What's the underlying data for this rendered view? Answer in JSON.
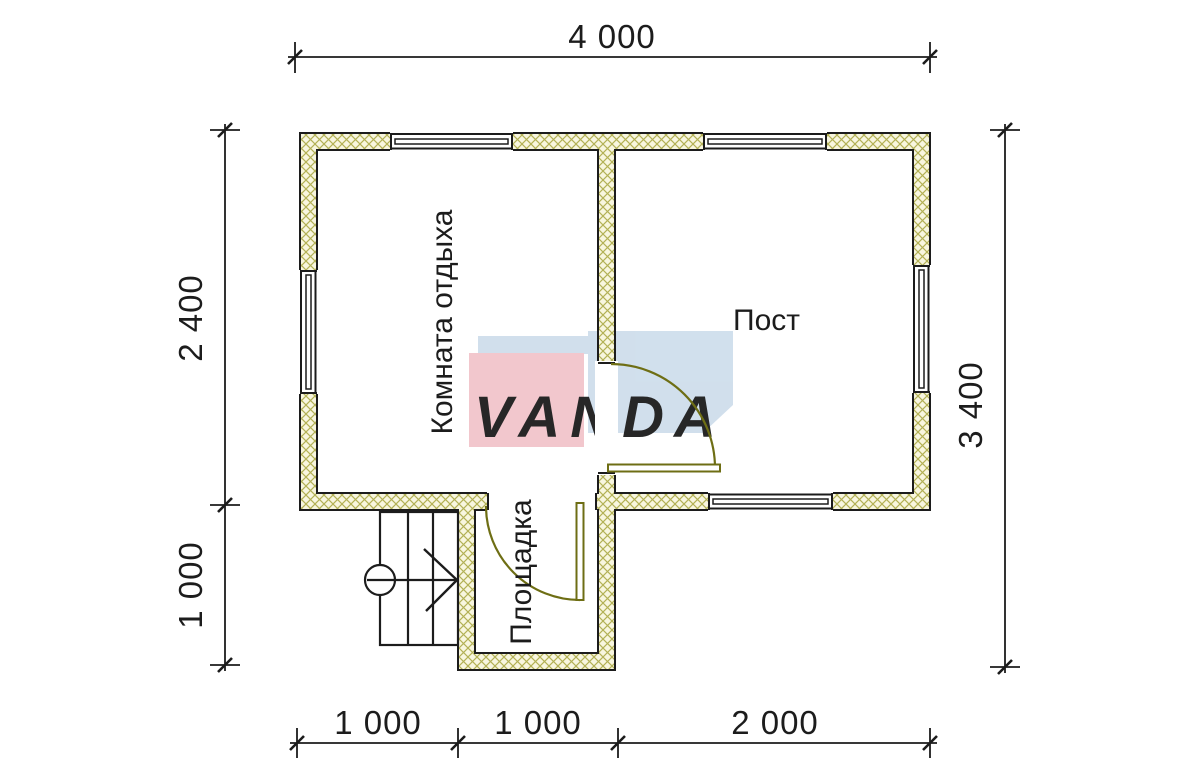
{
  "plan": {
    "rooms": {
      "rest": {
        "label": "Комната отдыха"
      },
      "post": {
        "label": "Пост"
      },
      "landing": {
        "label": "Площадка"
      }
    },
    "dimensions": {
      "top": "4 000",
      "left_upper": "2 400",
      "left_lower": "1 000",
      "right": "3 400",
      "bottom_left": "1 000",
      "bottom_mid": "1 000",
      "bottom_right": "2 000"
    }
  },
  "watermark": {
    "brand": "VANDA",
    "blue": "#cfdeec",
    "pink": "#f2c5cb",
    "text_color": "#ffffff"
  },
  "colors": {
    "background": "#ffffff",
    "line": "#1c1c1c",
    "wall_fill": "#f8f6df",
    "wall_hatch": "#b3b156",
    "door": "#6e6e14"
  }
}
